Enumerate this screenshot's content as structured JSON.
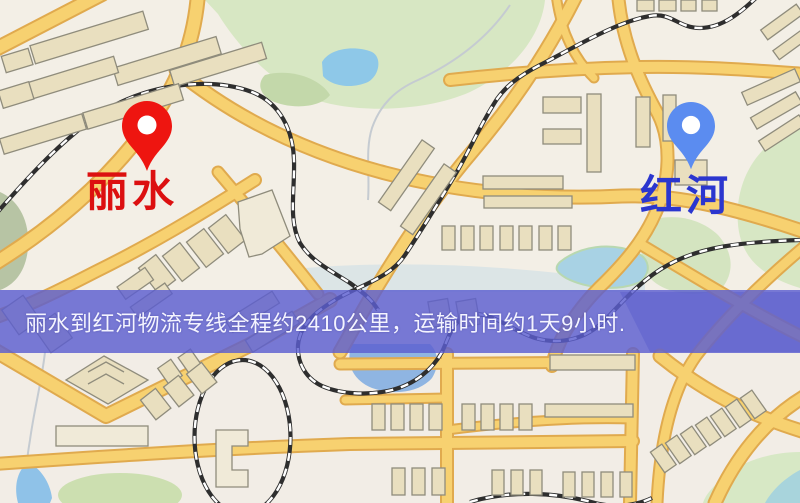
{
  "banner": {
    "text": "丽水到红河物流专线全程约2410公里，运输时间约1天9小时.",
    "background_color": "#5c5ed0",
    "text_color": "#f4f4ff"
  },
  "route_info": {
    "origin": "丽水",
    "destination": "红河",
    "distance_km": "2410",
    "duration": "1天9小时"
  },
  "markers": {
    "origin": {
      "label": "丽水",
      "pin_color": "#ee1510",
      "label_color": "#dc1010",
      "pin_icon": "red-location-pin"
    },
    "destination": {
      "label": "红河",
      "pin_color": "#5b8cf0",
      "label_color": "#2b36cf",
      "pin_icon": "blue-location-pin"
    }
  },
  "map_palette": {
    "background": "#f3efe6",
    "road_fill": "#f7d170",
    "road_casing": "#e0aa4e",
    "park_green": "#d7e7c3",
    "water_blue": "#8fc2e8",
    "building_beige": "#e9dfbf",
    "railway_black": "#2e2e2e"
  }
}
